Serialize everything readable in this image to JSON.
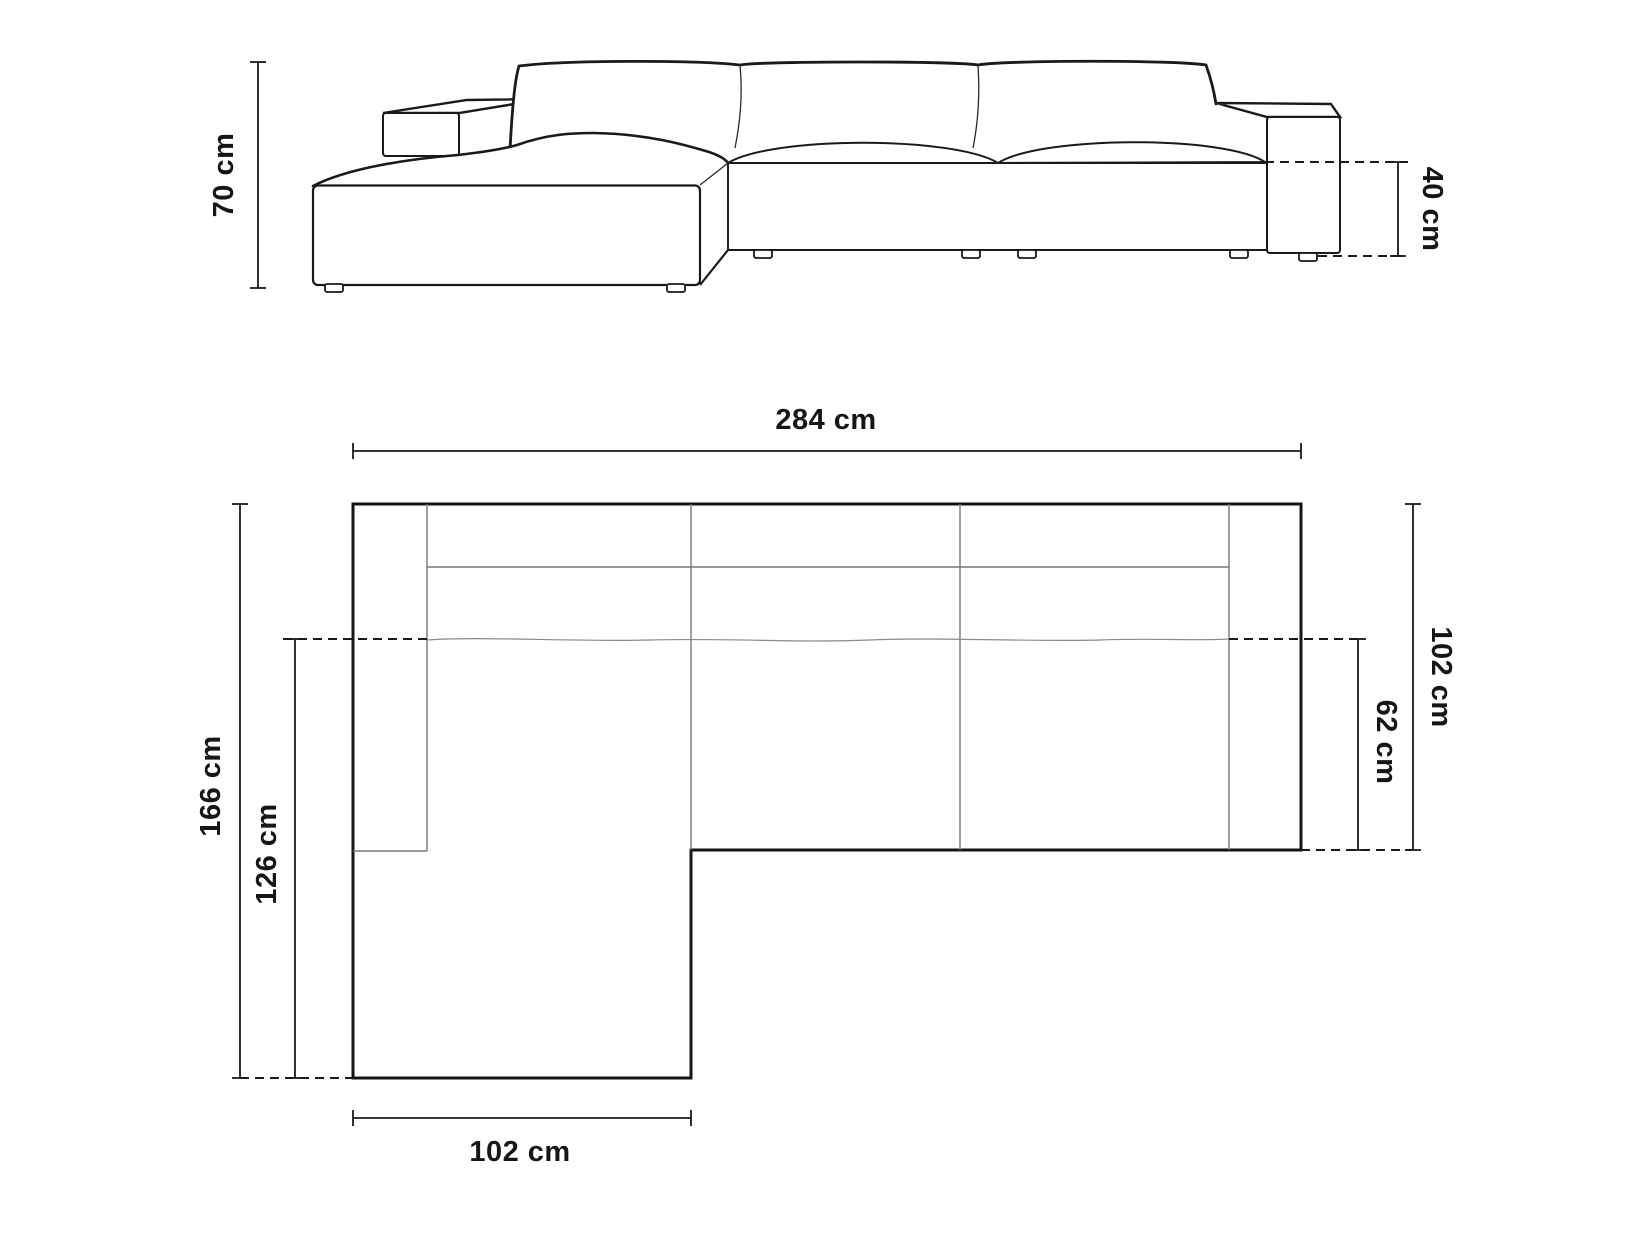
{
  "front_view": {
    "height_label": "70 cm",
    "seat_height_label": "40 cm"
  },
  "top_view": {
    "width_label": "284 cm",
    "total_depth_label": "166 cm",
    "chaise_length_label": "126 cm",
    "depth_label": "102 cm",
    "seat_depth_label": "62 cm",
    "chaise_width_label": "102 cm"
  },
  "colors": {
    "line": "#1a1a1a",
    "secondary_line": "#777777",
    "background": "#ffffff"
  }
}
